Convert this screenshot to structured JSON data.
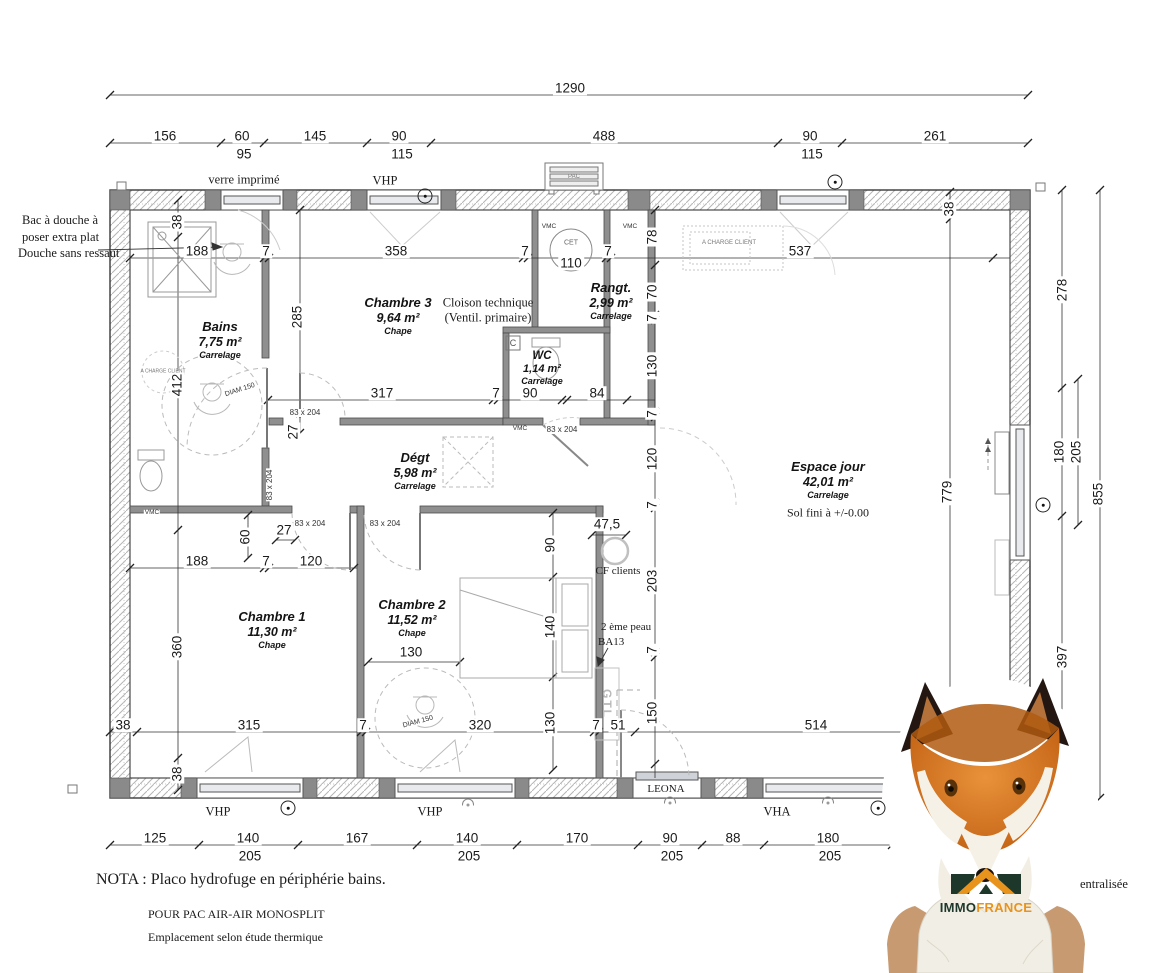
{
  "rooms": {
    "bains": {
      "name": "Bains",
      "area": "7,75 m²",
      "floor": "Carrelage"
    },
    "chambre3": {
      "name": "Chambre 3",
      "area": "9,64 m²",
      "floor": "Chape"
    },
    "wc": {
      "name": "WC",
      "area": "1,14 m²",
      "floor": "Carrelage"
    },
    "rangt": {
      "name": "Rangt.",
      "area": "2,99 m²",
      "floor": "Carrelage"
    },
    "degt": {
      "name": "Dégt",
      "area": "5,98 m²",
      "floor": "Carrelage"
    },
    "espace_jour": {
      "name": "Espace jour",
      "area": "42,01 m²",
      "floor": "Carrelage",
      "level": "Sol fini à +/-0.00"
    },
    "chambre1": {
      "name": "Chambre 1",
      "area": "11,30 m²",
      "floor": "Chape"
    },
    "chambre2": {
      "name": "Chambre 2",
      "area": "11,52 m²",
      "floor": "Chape"
    }
  },
  "labels": {
    "verre_imprime": "verre imprimé",
    "vhp": "VHP",
    "vha": "VHA",
    "leona": "LEONA",
    "pac": "PAC",
    "cet": "CET",
    "cet_dim": "110",
    "vmc": "VMC",
    "c_box": "C",
    "gtl": "GTL",
    "cf_clients": "CF clients",
    "peau1": "2 ème peau",
    "peau2": "BA13",
    "cloison1": "Cloison technique",
    "cloison2": "(Ventil. primaire)",
    "charge_client": "A CHARGE CLIENT",
    "diam": "DIAM 150",
    "door": "83 x 204",
    "centralisee": "entralisée"
  },
  "annotations": {
    "shower_line1": "Bac à douche à",
    "shower_line2": "poser extra plat",
    "shower_line3": "Douche sans ressaut",
    "nota": "NOTA : Placo hydrofuge en périphérie bains.",
    "pac_line1": "POUR PAC AIR-AIR MONOSPLIT",
    "pac_line2": "Emplacement selon étude thermique"
  },
  "brand": {
    "immo": "IMMO",
    "france": "FRANCE"
  },
  "dims": {
    "total_w": "1290",
    "total_h": "855",
    "inner_h": "779",
    "top": [
      "156",
      "60",
      "145",
      "90",
      "488",
      "90",
      "261"
    ],
    "top_sub": [
      "95",
      "115",
      "115"
    ],
    "chain_a": [
      "188",
      "7",
      "358",
      "7",
      "110",
      "7",
      "537"
    ],
    "chain_b": [
      "317",
      "7",
      "90",
      "84"
    ],
    "chain_c": [
      "188",
      "7",
      "120"
    ],
    "chain_d": [
      "38",
      "315",
      "7",
      "320",
      "7",
      "51",
      "514"
    ],
    "bottom": [
      "125",
      "140",
      "167",
      "140",
      "170",
      "90",
      "88",
      "180"
    ],
    "bottom_sub": [
      "205",
      "205",
      "205",
      "205"
    ],
    "mid_v": [
      "78",
      "70",
      "7",
      "130",
      "7",
      "120",
      "7",
      "203",
      "7",
      "150"
    ],
    "c2_v": [
      "90",
      "140",
      "130"
    ],
    "right": [
      "278",
      "180",
      "205",
      "397"
    ],
    "misc": {
      "v38a": "38",
      "v412": "412",
      "v360": "360",
      "v38c": "38",
      "v38b": "38",
      "v285": "285",
      "v60": "60",
      "v27a": "27",
      "v27b": "27",
      "v475": "47,5",
      "bed": "130"
    }
  }
}
